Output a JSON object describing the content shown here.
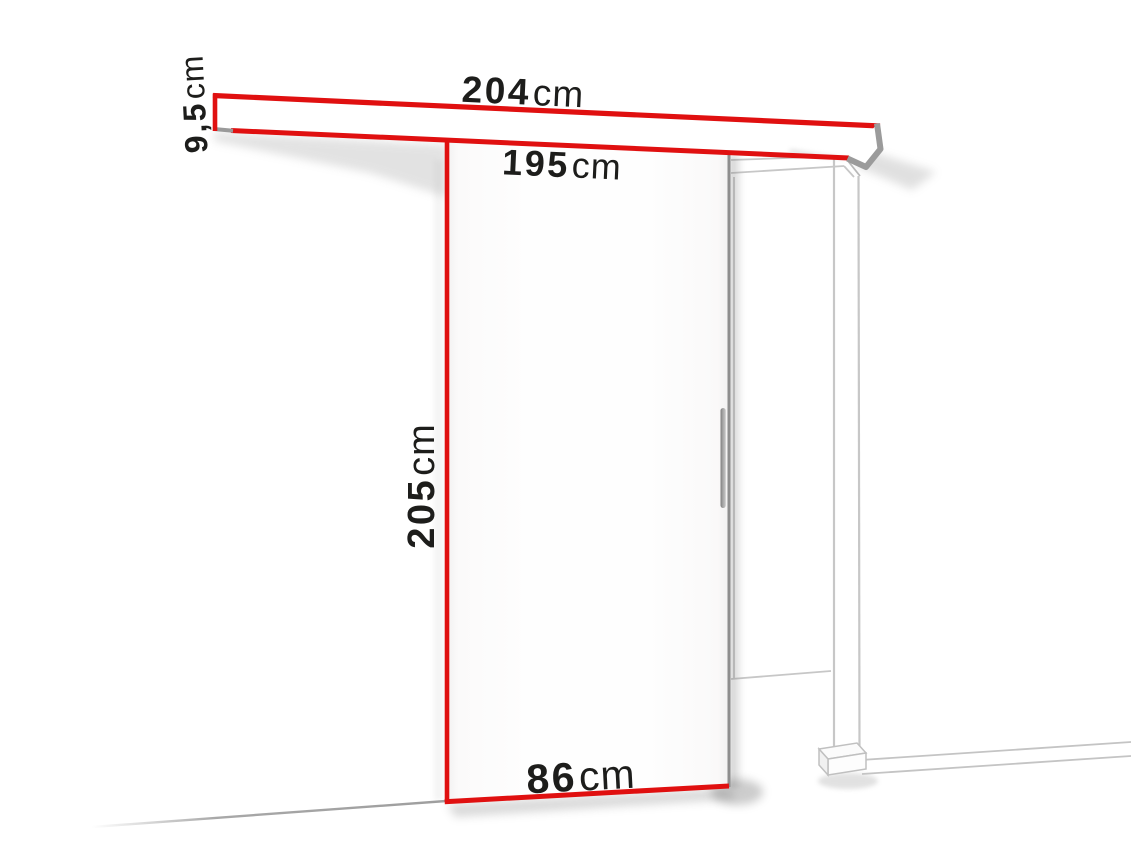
{
  "diagram": {
    "kind": "sliding-door-dimension-diagram",
    "background": "#ffffff",
    "colors": {
      "accent_red": "#e01010",
      "door_edge_gray": "#8e8e8e",
      "frame_line_gray": "#c7c7c7",
      "text": "#1d1d1b"
    },
    "labels": {
      "rail_length": {
        "value": "204",
        "unit": "cm"
      },
      "rail_height": {
        "value": "9,5",
        "unit": "cm"
      },
      "clear_width": {
        "value": "195",
        "unit": "cm"
      },
      "door_height": {
        "value": "205",
        "unit": "cm"
      },
      "door_width": {
        "value": "86",
        "unit": "cm"
      }
    }
  }
}
